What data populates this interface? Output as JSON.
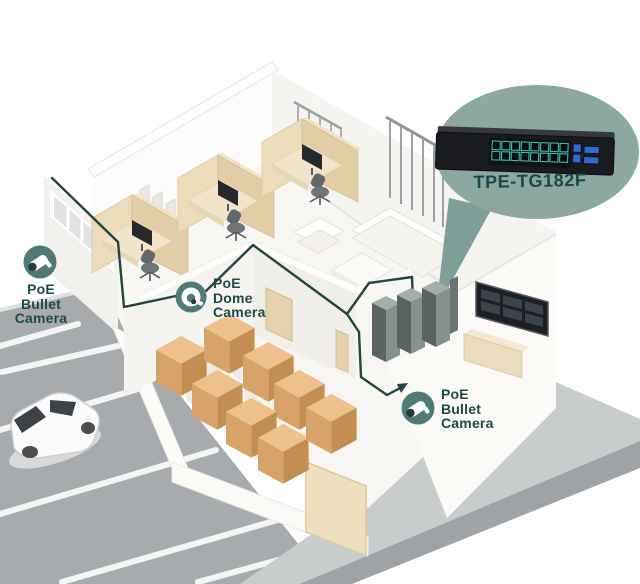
{
  "switch_callout": {
    "model": "TPE-TG182F",
    "rj45_ports": 16,
    "uplink_ports": 2,
    "sfp_slots": 2
  },
  "camera_callouts": [
    {
      "position": "left-wall",
      "type": "bullet",
      "label": "PoE\nBullet\nCamera"
    },
    {
      "position": "interior-wall",
      "type": "dome",
      "label": "PoE\nDome\nCamera"
    },
    {
      "position": "front-right-wall",
      "type": "bullet",
      "label": "PoE\nBullet\nCamera"
    }
  ],
  "colors": {
    "callout_bubble": "#8ca8a1",
    "callout_pointer": "#7fa099",
    "badge_teal": "#4e7b76",
    "label_teal": "#1c4a46",
    "cable": "#24443d",
    "port_teal": "#3fbdae",
    "port_blue": "#2b6cd4",
    "box_tan": "#d8a368",
    "parking_gray": "#a7abad"
  }
}
